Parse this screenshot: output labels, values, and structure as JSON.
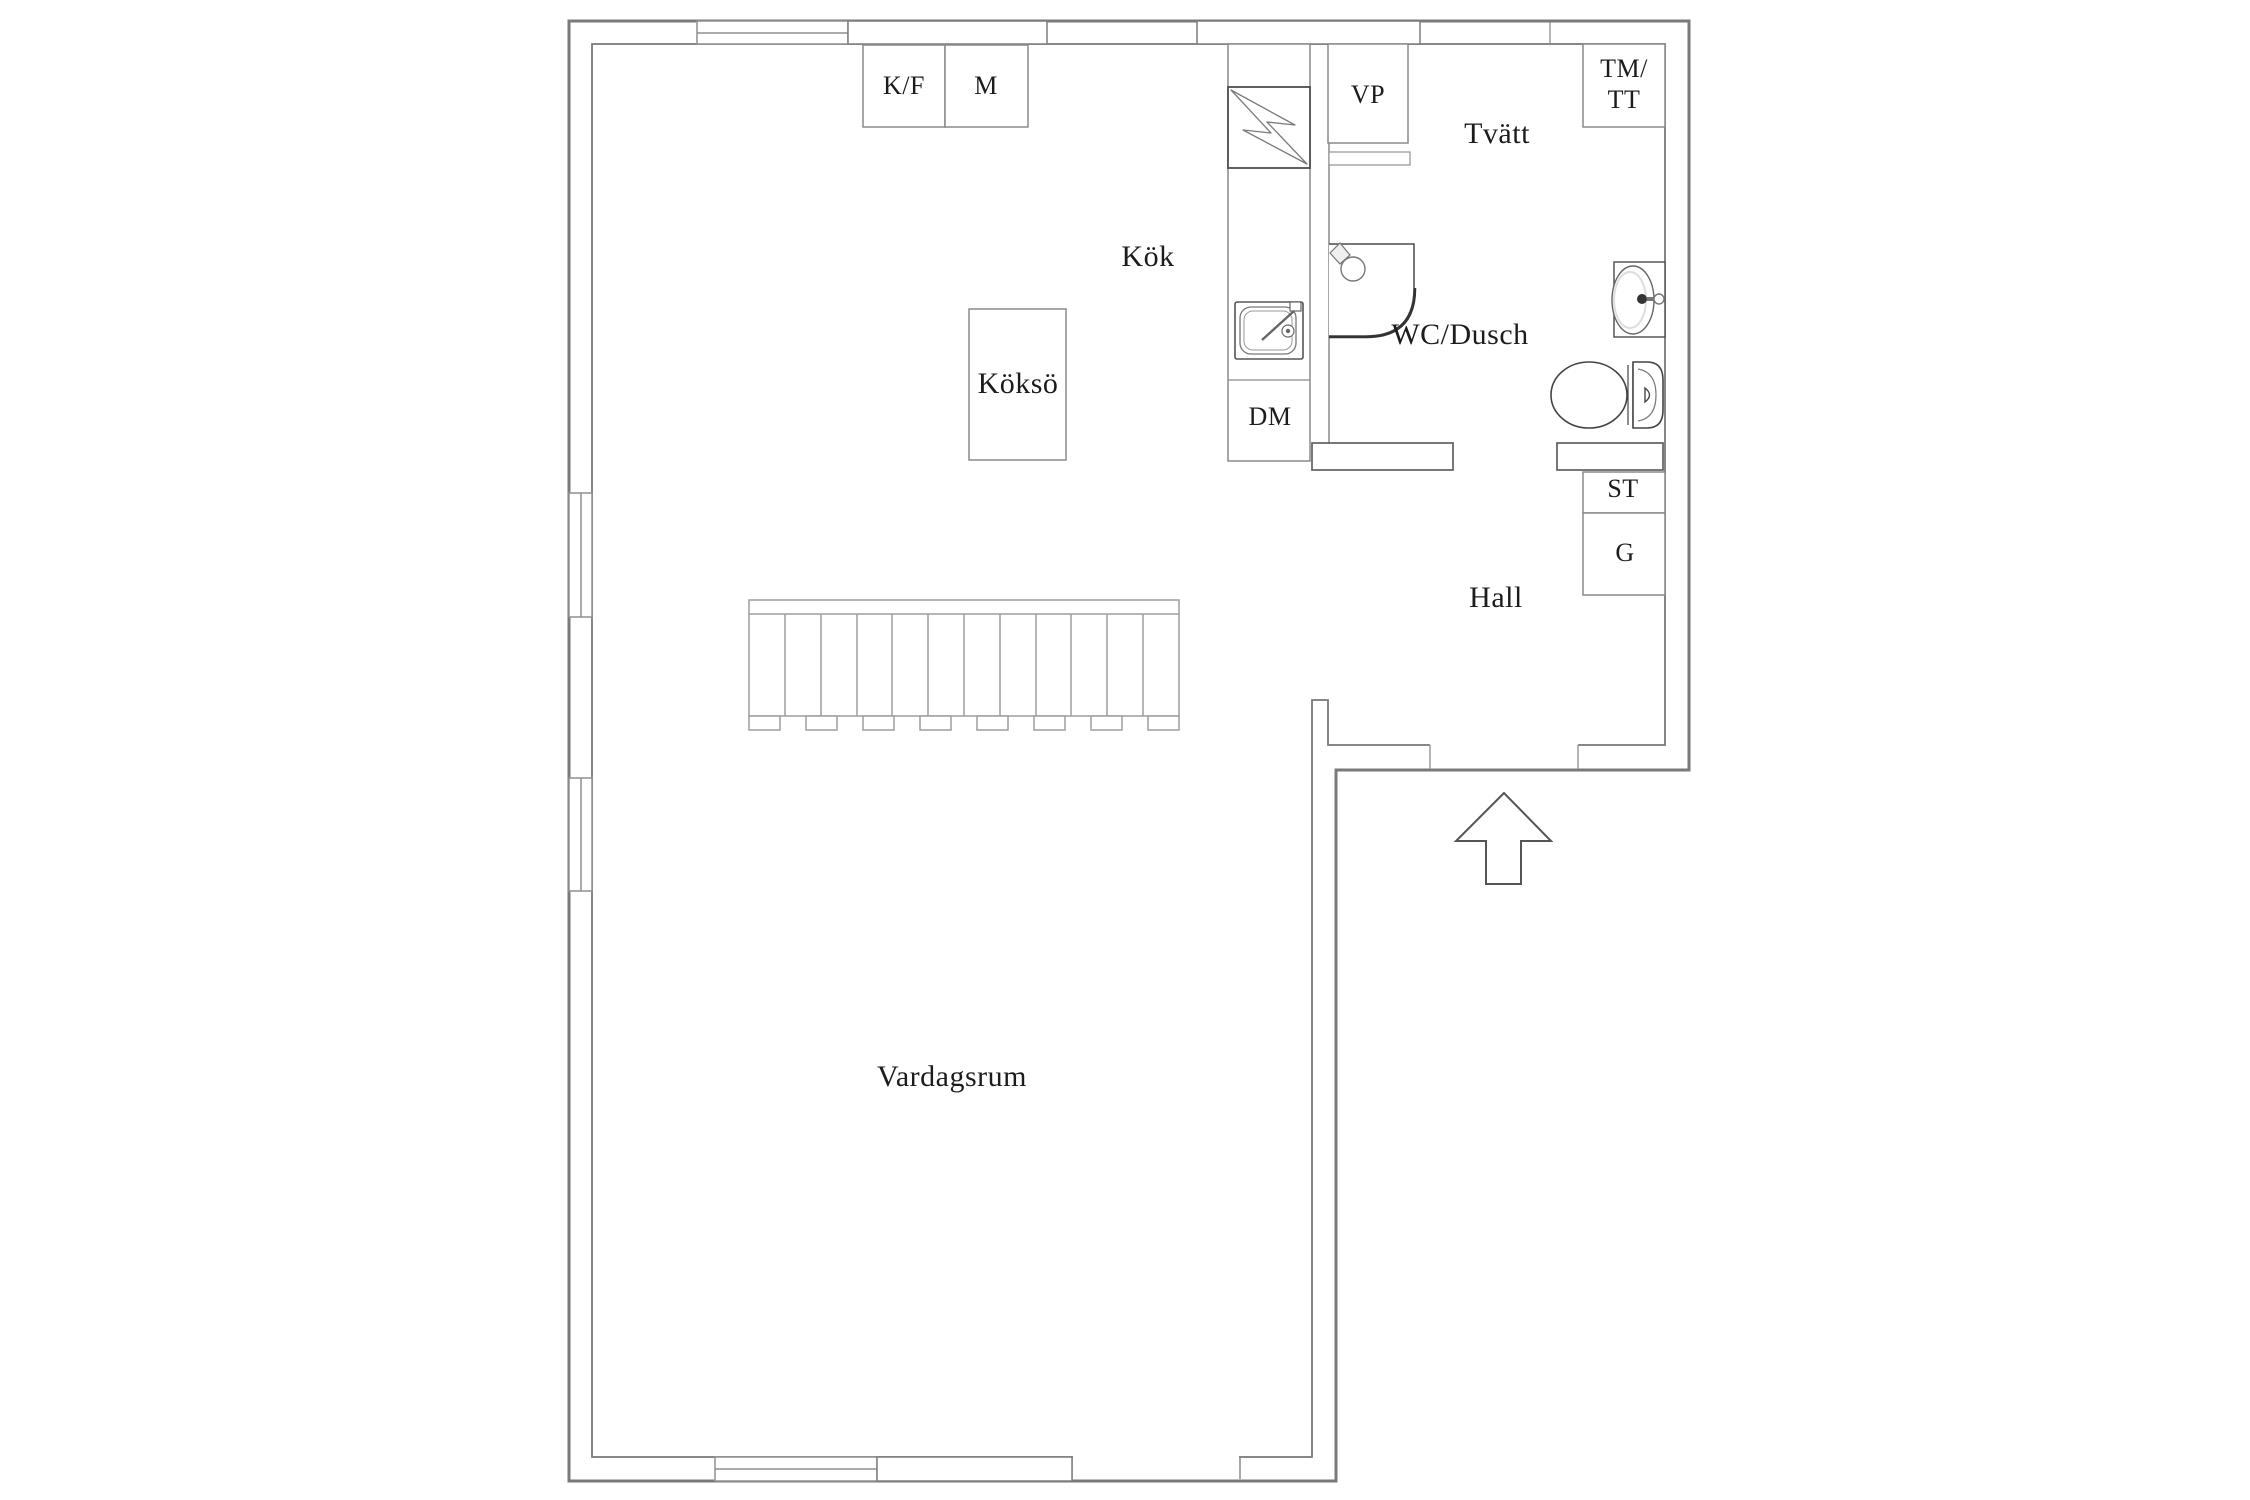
{
  "floorplan": {
    "rooms": {
      "kitchen": "Kök",
      "laundry": "Tvätt",
      "bathroom": "WC/Dusch",
      "hall": "Hall",
      "living_room": "Vardagsrum",
      "kitchen_island": "Köksö"
    },
    "units": {
      "fridge_freezer": "K/F",
      "oven": "M",
      "heat_pump": "VP",
      "washer_line1": "TM/",
      "washer_line2": "TT",
      "dishwasher": "DM",
      "storage": "ST",
      "wardrobe": "G"
    },
    "icons": {
      "electric_panel": "lightning-bolt-icon",
      "kitchen_sink": "sink-icon",
      "shower": "corner-shower-icon",
      "bathroom_sink": "oval-basin-icon",
      "toilet": "toilet-icon",
      "stairs": "staircase-icon",
      "entrance": "entrance-arrow-icon"
    },
    "colors": {
      "background": "#ffffff",
      "outer_wall": "#7a7a7a",
      "inner_wall": "#787878",
      "fixture_line": "#8a8a8a",
      "dark_fixture": "#444444",
      "text": "#1c1c1c"
    }
  }
}
